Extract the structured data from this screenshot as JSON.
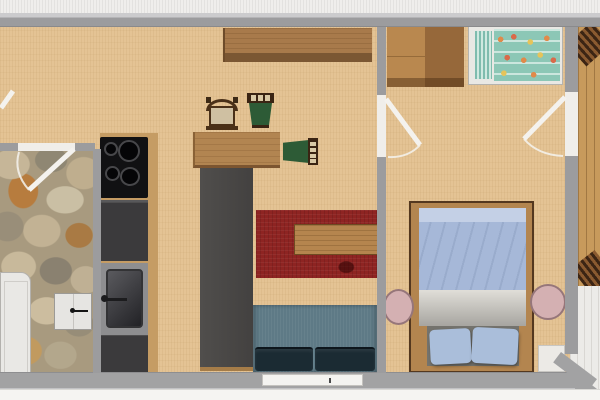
{
  "document": {
    "kind": "photographed 2D floor plan of a small apartment",
    "visible_text": ""
  },
  "palette": {
    "photo_background": "#f3f2ef",
    "wall_gray": "#9c9c9e",
    "wall_light": "#cbcbcd",
    "wood_floor": "#e4c394",
    "stone_floor": "#a89a7f",
    "balcony_wood": "#c79a5c",
    "tile_white": "#ecebe8",
    "door_white": "#f0eeea",
    "counter_dark": "#3b3a3c",
    "cooktop_black": "#111113",
    "counter_wood_edge": "#c59c64",
    "divider_dark": "#4b4947",
    "rug_red": "#8e2422",
    "coffee_table_wood": "#b5854e",
    "sofa_back_slate": "#5e7a86",
    "sofa_seat_dark": "#1b2b33",
    "dining_table_wood": "#b28551",
    "chair_seat_beige": "#cfc0a2",
    "chair_seat_green": "#2d5b36",
    "chair_frame_brown": "#3a2413",
    "sideboard_wood": "#a87a4b",
    "wardrobe_light": "#b9884f",
    "wardrobe_dark": "#96683a",
    "crib_frame_white": "#e9e8e4",
    "crib_teal": "#8cc7b6",
    "crib_dot_orange": "#e08a4a",
    "bed_frame_wood": "#b3854f",
    "duvet_blue": "#a6b8d8",
    "blanket_gray": "#d6d4cd",
    "pillow_blue": "#aabeda",
    "bed_foot_dark": "#74736d",
    "stool_pink": "#d4b0b2",
    "hall_cabinet_white": "#e6e5e2",
    "appliance_white": "#e9e8e5"
  },
  "floorplan": {
    "rooms": [
      {
        "name": "kitchen-living-room",
        "floor": "light wood"
      },
      {
        "name": "hallway",
        "floor": "natural stone"
      },
      {
        "name": "bedroom",
        "floor": "light wood"
      },
      {
        "name": "balcony",
        "floor": "vertical wood planks"
      },
      {
        "name": "terrace",
        "floor": "white tiles"
      }
    ],
    "furniture": [
      {
        "name": "cooktop-4-burners",
        "room": "kitchen-living-room"
      },
      {
        "name": "kitchen-counter-with-sink",
        "room": "kitchen-living-room"
      },
      {
        "name": "sideboard",
        "room": "kitchen-living-room"
      },
      {
        "name": "dining-table",
        "room": "kitchen-living-room"
      },
      {
        "name": "chair-beige-seat",
        "room": "kitchen-living-room"
      },
      {
        "name": "chair-green-seat-top",
        "room": "kitchen-living-room"
      },
      {
        "name": "chair-green-seat-right",
        "room": "kitchen-living-room"
      },
      {
        "name": "room-divider-dark",
        "room": "kitchen-living-room"
      },
      {
        "name": "red-rug",
        "room": "kitchen-living-room"
      },
      {
        "name": "coffee-table",
        "room": "kitchen-living-room"
      },
      {
        "name": "sofa-two-seat",
        "room": "kitchen-living-room"
      },
      {
        "name": "white-cabinet",
        "room": "hallway"
      },
      {
        "name": "white-appliance",
        "room": "hallway"
      },
      {
        "name": "wardrobe-two-tone",
        "room": "bedroom"
      },
      {
        "name": "crib-with-patterned-mattress",
        "room": "bedroom"
      },
      {
        "name": "double-bed-blue-bedding",
        "room": "bedroom"
      },
      {
        "name": "round-nightstand-left",
        "room": "bedroom"
      },
      {
        "name": "round-nightstand-right",
        "room": "bedroom"
      },
      {
        "name": "slatted-chair-top",
        "room": "balcony"
      },
      {
        "name": "slatted-chair-bottom",
        "room": "balcony"
      }
    ],
    "doors": [
      {
        "name": "entry-door-stub",
        "location": "left image edge"
      },
      {
        "name": "hallway-door",
        "location": "living room to hallway"
      },
      {
        "name": "bedroom-door-left",
        "location": "living room to bedroom"
      },
      {
        "name": "bedroom-door-right",
        "location": "bedroom to balcony"
      }
    ],
    "openings": [
      {
        "name": "window-or-door-bottom-wall",
        "location": "living room bottom wall"
      },
      {
        "name": "white-threshold",
        "location": "bedroom bottom right"
      }
    ]
  }
}
